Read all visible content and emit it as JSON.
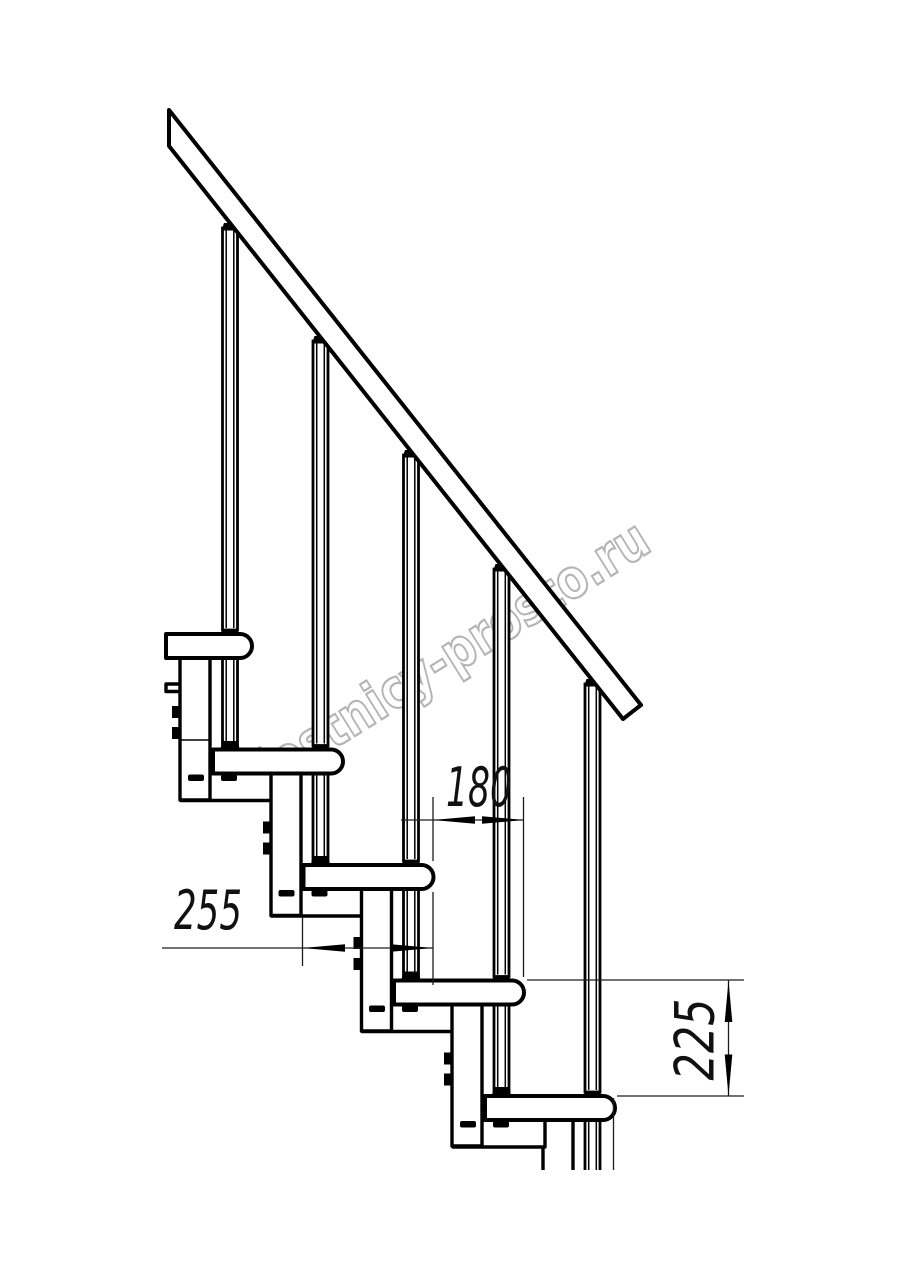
{
  "page": {
    "background": "#ffffff"
  },
  "watermark": {
    "text": "lestnicy-prosto.ru",
    "color": "#b4b4b4"
  },
  "drawing": {
    "line_color": "#000000",
    "dimension_color": "#1d1d1d",
    "dimensions": {
      "tread_depth": "255",
      "step_run": "180",
      "step_rise": "225"
    }
  }
}
